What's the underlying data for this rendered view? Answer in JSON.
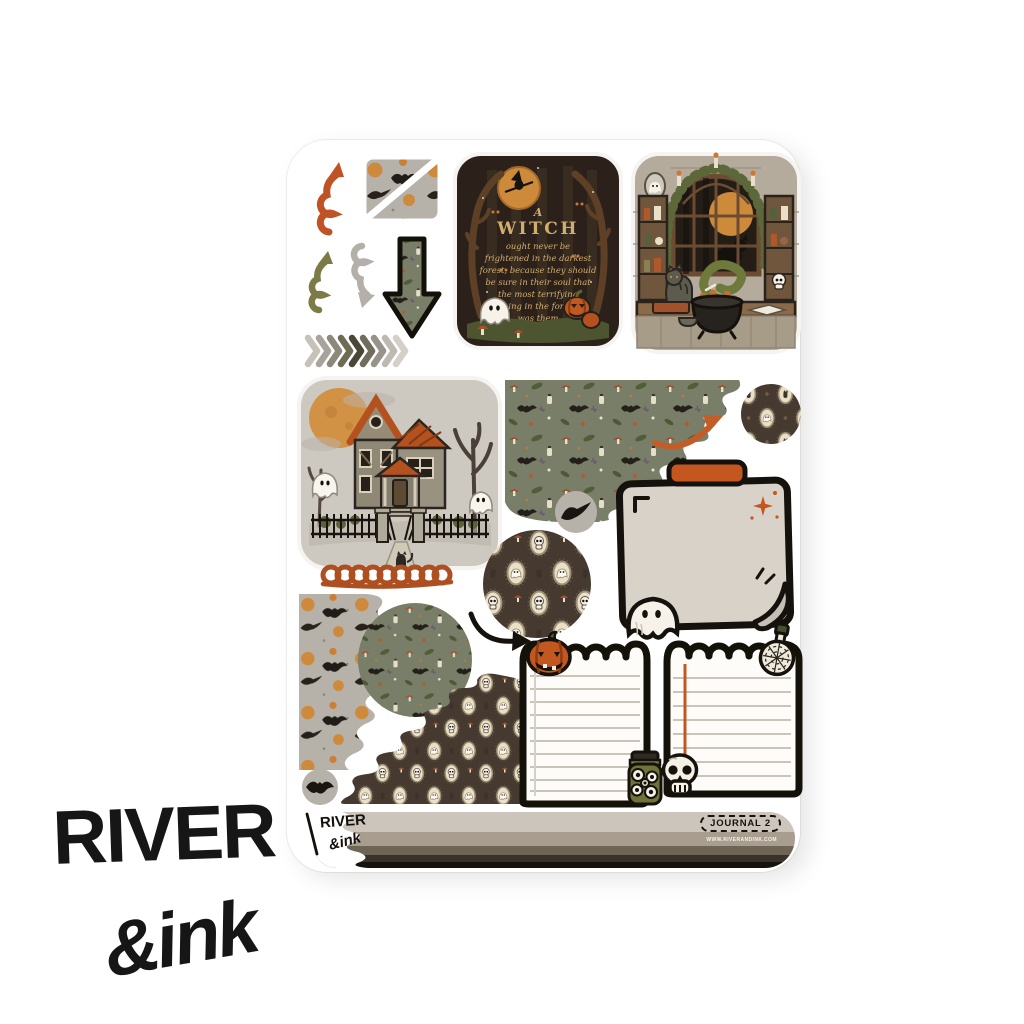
{
  "page": {
    "background": "#ffffff"
  },
  "watermark": {
    "line1": "RIVER",
    "line2": "&ink"
  },
  "sheet": {
    "witch_quote": {
      "lines": [
        "A",
        "WITCH",
        "ought never be",
        "frightened in the darkest",
        "forest, because they should",
        "be sure in their soul that",
        "the most terrifying",
        "thing in the forest",
        "was them"
      ]
    },
    "footer": {
      "logo_line1": "RIVER",
      "logo_line2": "&ink",
      "badge_label": "JOURNAL 2",
      "website": "WWW.RIVERANDINK.COM"
    }
  },
  "icons": {
    "ghost": "👻",
    "witch": "🧙",
    "jack_o_lantern": "🎃",
    "skull": "💀",
    "bat": "🦇",
    "crow": "🐦",
    "cat": "🐈",
    "cauldron": "🍲",
    "potion": "⚗",
    "eyeball_jar": "👁",
    "moon": "🌕",
    "mushroom": "🍄",
    "haunted_house": "🏚",
    "swirl_arrow": "➰",
    "down_arrow": "⬇",
    "curved_arrow": "↗",
    "chevrons": "»",
    "sparkle": "✦",
    "pen": "✎"
  },
  "colors": {
    "accent_orange": "#c2571f",
    "olive_green": "#7c7b45",
    "warm_gray": "#b7b2a9",
    "botanical_green": "#797e68",
    "frame_brown": "#463a30",
    "paper_beige": "#d9d2c9",
    "ink_black": "#16120e",
    "bar_stripes": [
      "#cbc5bc",
      "#a89d8e",
      "#6e6557",
      "#3a3229",
      "#16120d"
    ]
  }
}
